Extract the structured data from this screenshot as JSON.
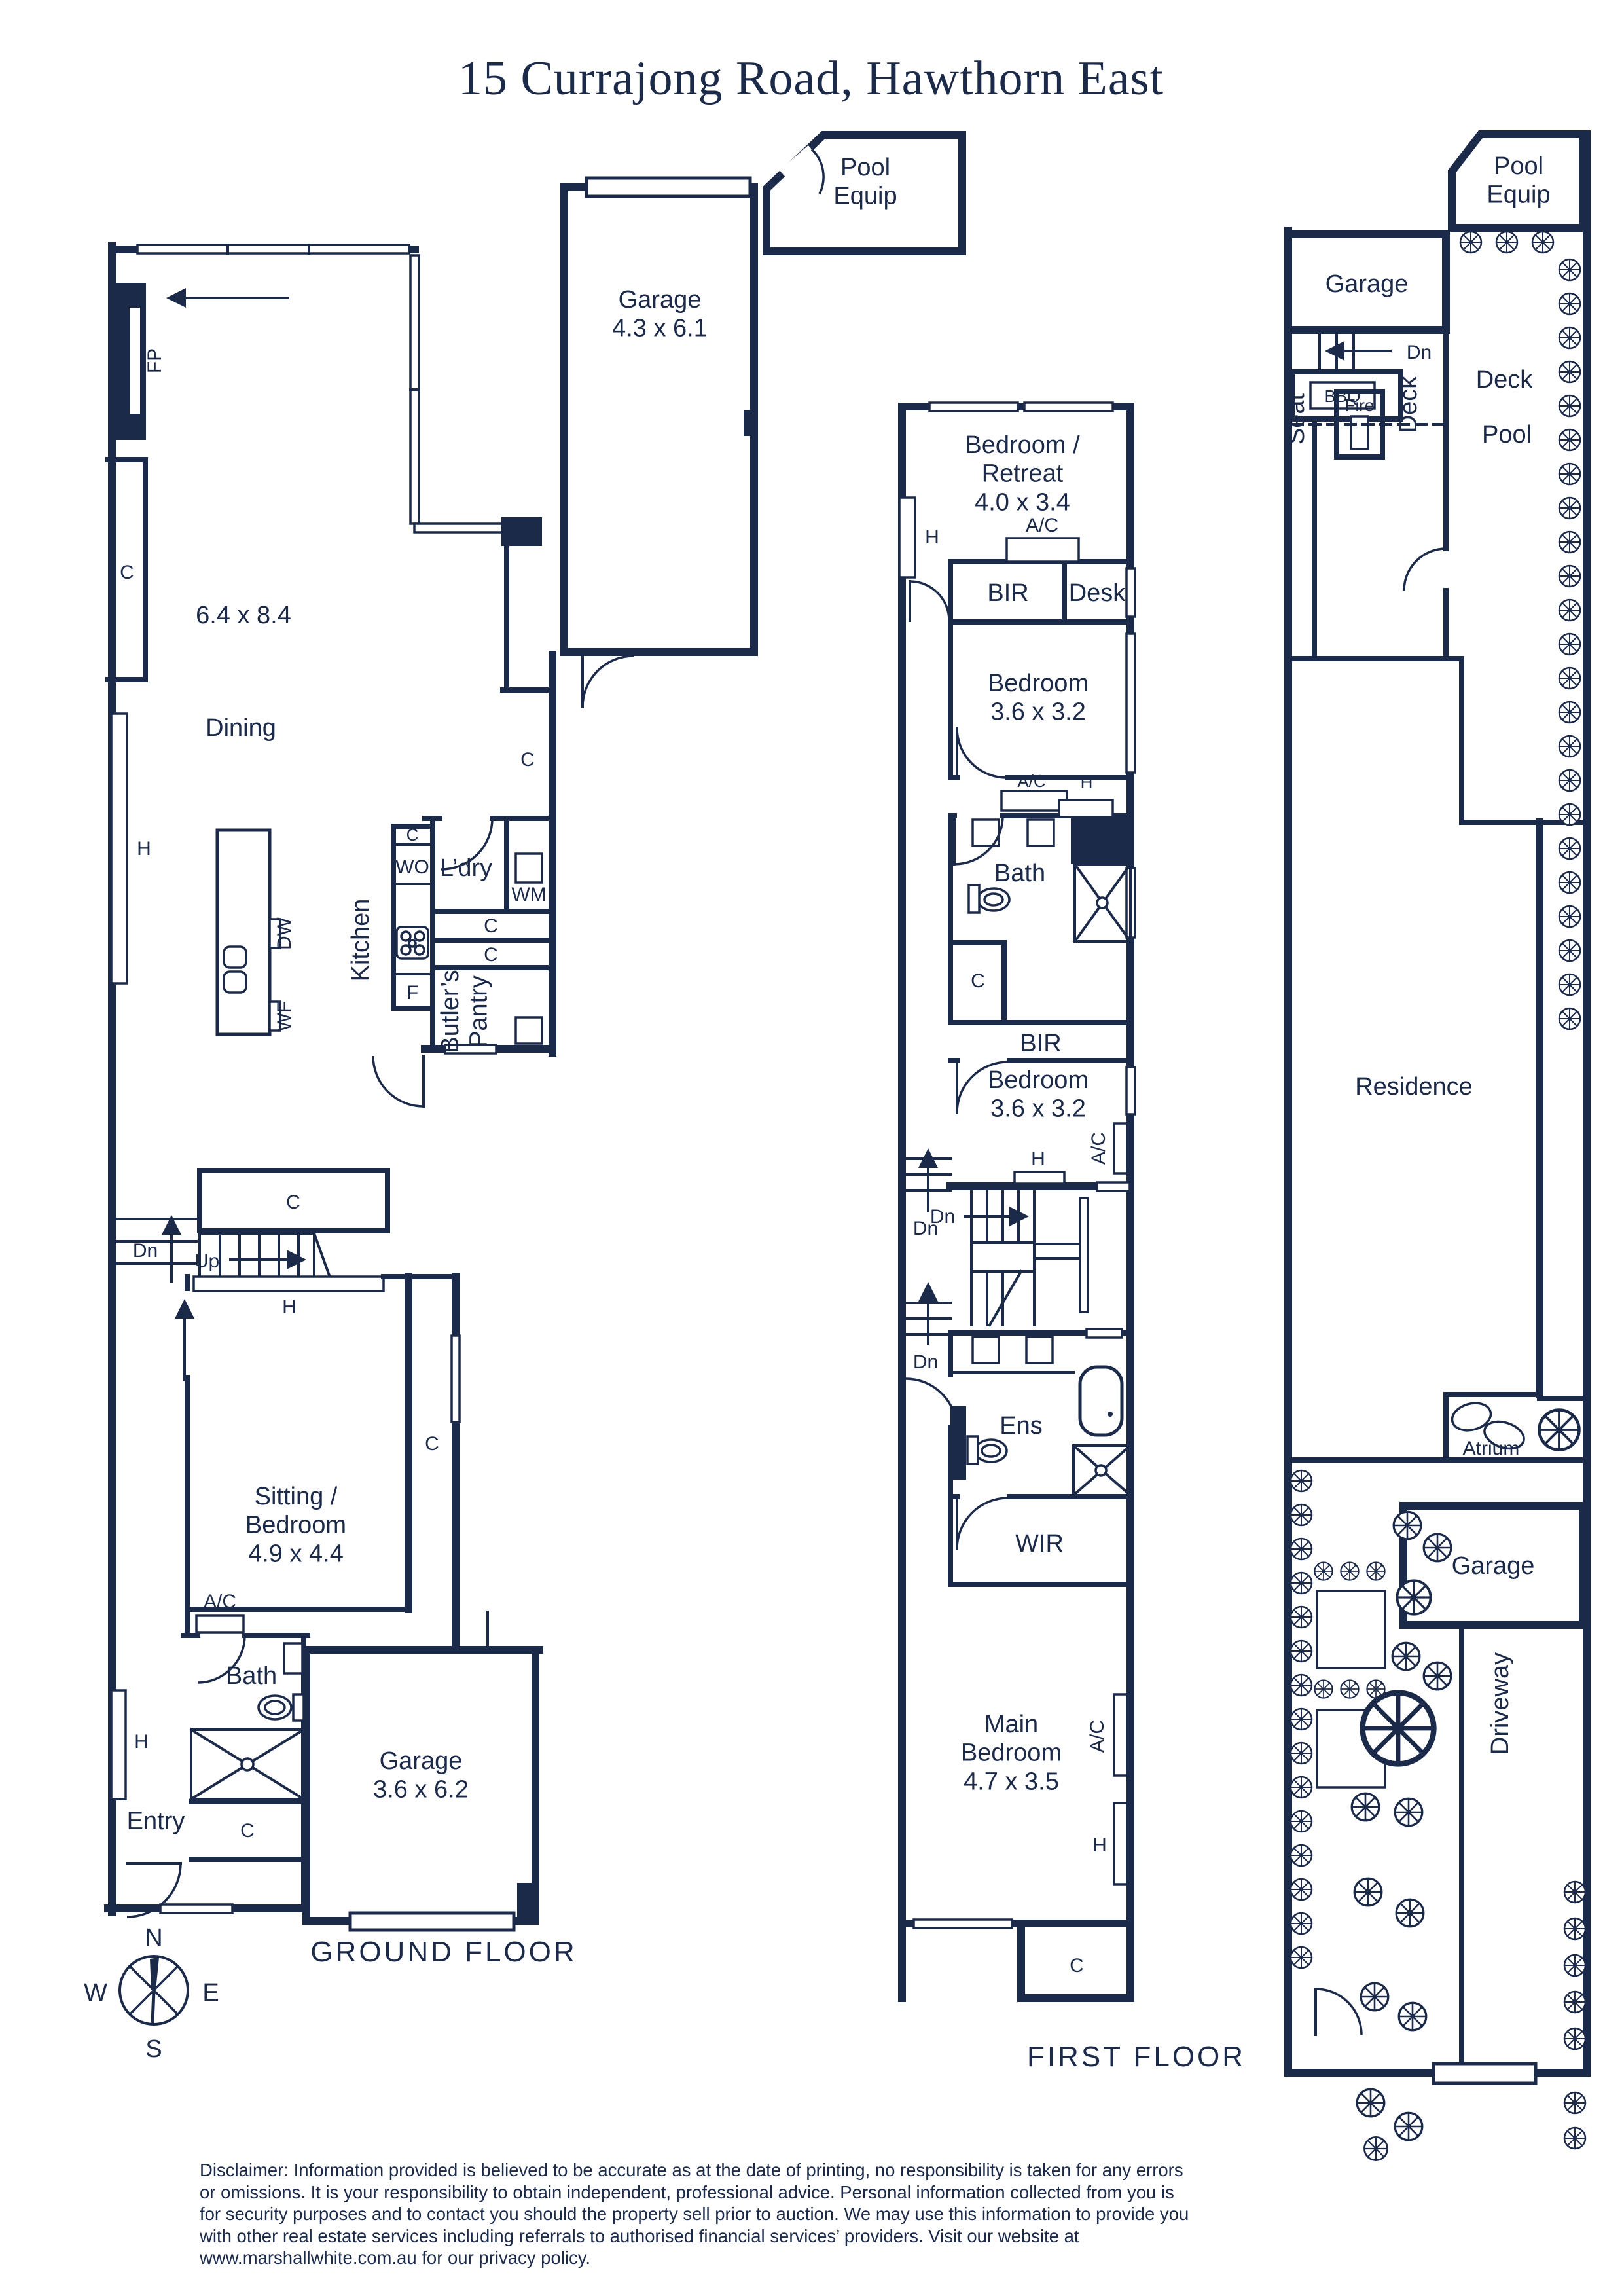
{
  "title": "15 Currajong Road, Hawthorn East",
  "palette": {
    "ink": "#1c2a4a",
    "paper": "#ffffff"
  },
  "legend": {
    "c": "C",
    "h": "H",
    "fp": "FP",
    "ac": "A/C",
    "dn": "Dn",
    "up": "Up",
    "f": "F",
    "wo": "WO",
    "wm": "WM",
    "dw": "DW",
    "wf": "WF",
    "bir": "BIR",
    "wir": "WIR",
    "desk": "Desk",
    "bath": "Bath",
    "ens": "Ens",
    "entry": "Entry",
    "ldry": "L’dry",
    "kitchen": "Kitchen",
    "dining": "Dining",
    "butlers_pantry": "Butler’s\nPantry",
    "seat": "Seat",
    "fire": "Fire",
    "bbq": "BBQ",
    "deck": "Deck",
    "pool": "Pool",
    "pool_equip": "Pool\nEquip",
    "residence": "Residence",
    "atrium": "Atrium",
    "garage": "Garage",
    "driveway": "Driveway"
  },
  "ground_floor": {
    "caption": "GROUND FLOOR",
    "living_dims": "6.4 x 8.4",
    "sitting_room": "Sitting /\nBedroom\n4.9 x 4.4",
    "garage": "Garage\n3.6 x 6.2"
  },
  "upper_garage": {
    "label": "Garage\n4.3 x 6.1"
  },
  "first_floor": {
    "caption": "FIRST FLOOR",
    "retreat": "Bedroom /\nRetreat\n4.0 x 3.4",
    "bedroom": "Bedroom\n3.6 x 3.2",
    "main_bedroom": "Main\nBedroom\n4.7 x 3.5"
  },
  "compass": {
    "n": "N",
    "e": "E",
    "s": "S",
    "w": "W"
  },
  "disclaimer": "Disclaimer: Information provided is believed to be accurate as at the date of printing, no responsibility is taken for any errors or omissions. It is your responsibility to obtain independent, professional advice. Personal information collected from you is for security purposes and to contact you should the property sell prior to auction. We may use this information to provide you with other real estate services including referrals to authorised financial services’ providers. Visit our website at www.marshallwhite.com.au for our privacy policy."
}
